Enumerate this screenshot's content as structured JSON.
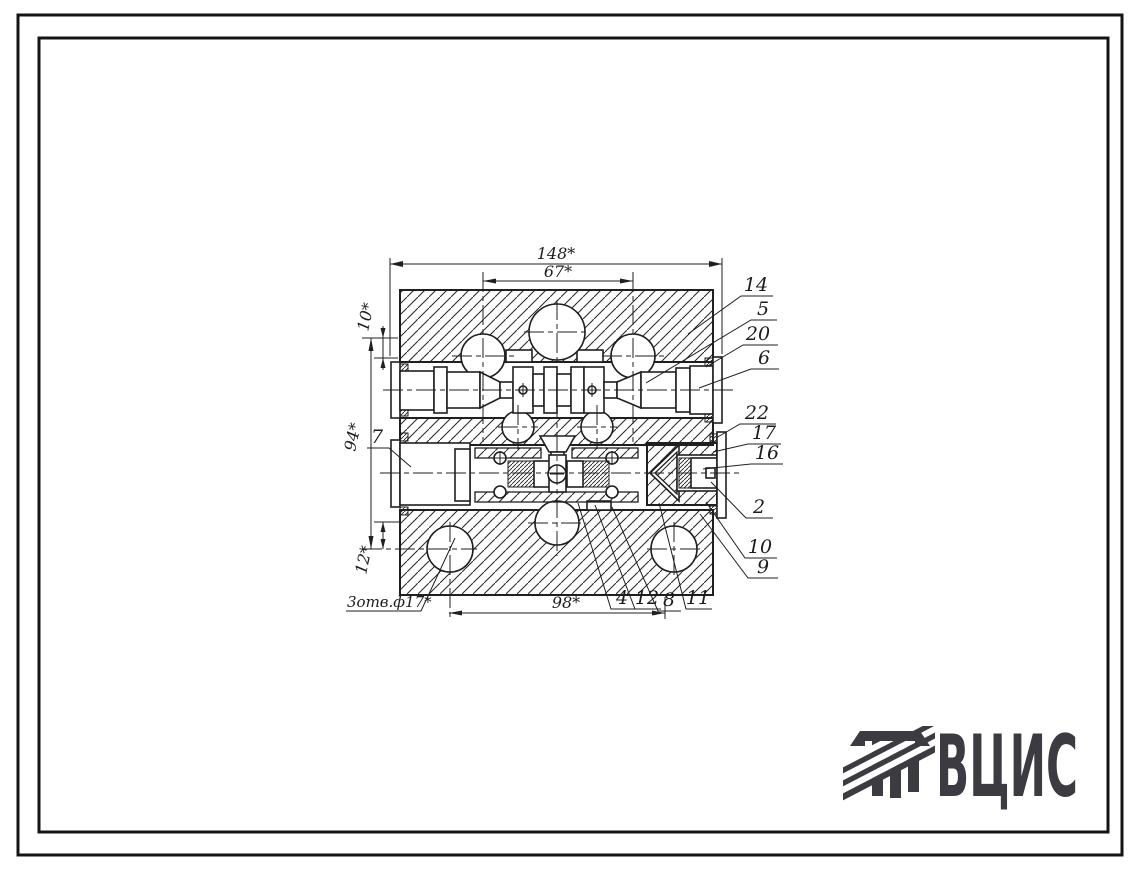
{
  "page": {
    "background": "#ffffff",
    "ink": "#1f1f1f",
    "logo_color": "#3b3b41"
  },
  "drawing": {
    "dimensions": {
      "top_total": "148*",
      "top_inner": "67*",
      "left_offset_top": "10*",
      "left_total": "94*",
      "left_offset_bottom": "12*",
      "bottom_width": "98*",
      "holes_note": "3отв.ф17*"
    },
    "callouts": {
      "right": [
        "14",
        "5",
        "20",
        "6",
        "22",
        "17",
        "16",
        "2",
        "10",
        "9"
      ],
      "left": [
        "7"
      ],
      "bottom": [
        "4",
        "12",
        "8",
        "11"
      ]
    }
  },
  "logo": {
    "text": "ВЦИС"
  }
}
